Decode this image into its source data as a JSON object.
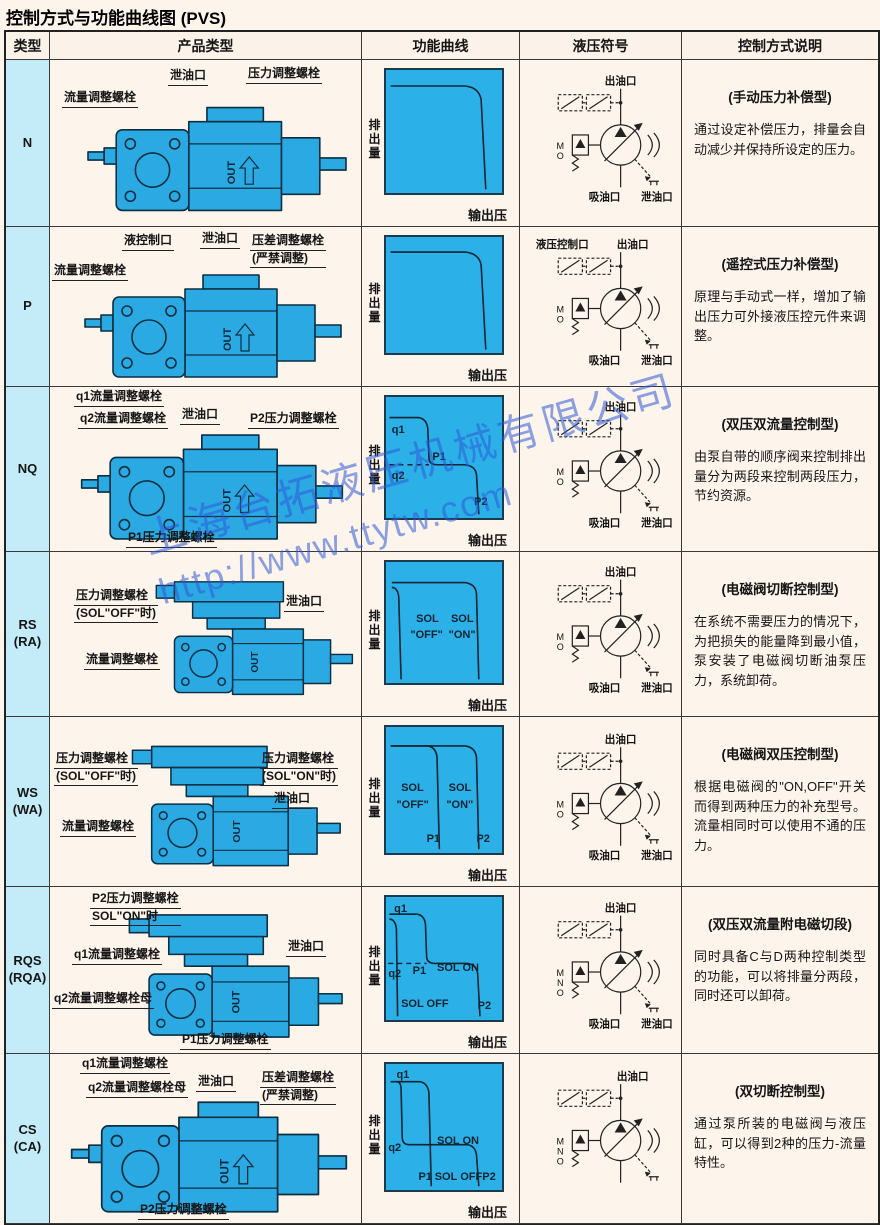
{
  "page": {
    "title": "控制方式与功能曲线图 (PVS)"
  },
  "shared": {
    "pump_text": "OUT",
    "axis_y": "排出量",
    "axis_x": "输出压"
  },
  "watermark": {
    "line1": "上海台拓液压机械有限公司",
    "line2": "http://www.ttytw.com"
  },
  "table": {
    "headers": [
      "类型",
      "产品类型",
      "功能曲线",
      "液压符号",
      "控制方式说明"
    ],
    "rows": [
      {
        "type": "N",
        "type_sub": "",
        "product_labels": [
          {
            "text": "流量调整螺栓"
          },
          {
            "text": "泄油口"
          },
          {
            "text": "压力调整螺栓"
          }
        ],
        "curve_labels": [],
        "symbol": {
          "top": "出油口",
          "bottom_left": "吸油口",
          "bottom_right": "泄油口",
          "letters": [
            "M",
            "O"
          ]
        },
        "desc_title": "(手动压力补偿型)",
        "desc_body": "通过设定补偿压力，排量会自动减少并保持所设定的压力。"
      },
      {
        "type": "P",
        "type_sub": "",
        "product_labels": [
          {
            "text": "流量调整螺栓"
          },
          {
            "text": "液控制口"
          },
          {
            "text": "泄油口"
          },
          {
            "text": "压差调整螺栓",
            "text2": "(严禁调整)"
          }
        ],
        "curve_labels": [],
        "symbol": {
          "top_left": "液压控制口",
          "top": "出油口",
          "bottom_left": "吸油口",
          "bottom_right": "泄油口",
          "letters": [
            "M",
            "O"
          ]
        },
        "desc_title": "(遥控式压力补偿型)",
        "desc_body": "原理与手动式一样，增加了输出压力可外接液压控元件来调整。"
      },
      {
        "type": "NQ",
        "type_sub": "",
        "product_labels": [
          {
            "text": "q1流量调整螺栓"
          },
          {
            "text": "q2流量调整螺栓"
          },
          {
            "text": "泄油口"
          },
          {
            "text": "P2压力调整螺栓"
          },
          {
            "text": "P1压力调整螺栓"
          }
        ],
        "curve_labels": [
          "q1",
          "P1",
          "q2",
          "P2"
        ],
        "symbol": {
          "top": "出油口",
          "bottom_left": "吸油口",
          "bottom_right": "泄油口",
          "letters": [
            "M",
            "O"
          ]
        },
        "desc_title": "(双压双流量控制型)",
        "desc_body": "由泵自带的顺序阀来控制排出量分为两段来控制两段压力，节约资源。"
      },
      {
        "type": "RS",
        "type_sub": "(RA)",
        "product_labels": [
          {
            "text": "压力调整螺栓",
            "text2": "(SOL\"OFF\"时)"
          },
          {
            "text": "泄油口"
          },
          {
            "text": "流量调整螺栓"
          }
        ],
        "curve_labels": [
          "SOL",
          "\"OFF\"",
          "SOL",
          "\"ON\""
        ],
        "symbol": {
          "top": "出油口",
          "bottom_left": "吸油口",
          "bottom_right": "泄油口",
          "letters": [
            "M",
            "O"
          ]
        },
        "desc_title": "(电磁阀切断控制型)",
        "desc_body": "在系统不需要压力的情况下，为把损失的能量降到最小值，泵安装了电磁阀切断油泵压力，系统卸荷。"
      },
      {
        "type": "WS",
        "type_sub": "(WA)",
        "product_labels": [
          {
            "text": "压力调整螺栓",
            "text2": "(SOL\"OFF\"时)"
          },
          {
            "text": "压力调整螺栓",
            "text2": "(SOL\"ON\"时)"
          },
          {
            "text": "泄油口"
          },
          {
            "text": "流量调整螺栓"
          }
        ],
        "curve_labels": [
          "SOL",
          "\"OFF\"",
          "SOL",
          "\"ON\"",
          "P1",
          "P2"
        ],
        "symbol": {
          "top": "出油口",
          "bottom_left": "吸油口",
          "bottom_right": "泄油口",
          "letters": [
            "M",
            "O"
          ]
        },
        "desc_title": "(电磁阀双压控制型)",
        "desc_body": "根据电磁阀的\"ON,OFF\"开关而得到两种压力的补充型号。流量相同时可以使用不通的压力。"
      },
      {
        "type": "RQS",
        "type_sub": "(RQA)",
        "product_labels": [
          {
            "text": "P2压力调整螺栓",
            "text2": "SOL\"ON\"时"
          },
          {
            "text": "q1流量调整螺栓"
          },
          {
            "text": "q2流量调整螺栓母"
          },
          {
            "text": "泄油口"
          },
          {
            "text": "P1压力调整螺栓"
          }
        ],
        "curve_labels": [
          "q1",
          "q2",
          "P1",
          "SOL ON",
          "SOL OFF",
          "P2"
        ],
        "symbol": {
          "top": "出油口",
          "bottom_left": "吸油口",
          "bottom_right": "泄油口",
          "letters": [
            "M",
            "N",
            "O"
          ]
        },
        "desc_title": "(双压双流量附电磁切段)",
        "desc_body": "同时具备C与D两种控制类型的功能，可以将排量分两段，同时还可以卸荷。"
      },
      {
        "type": "CS",
        "type_sub": "(CA)",
        "product_labels": [
          {
            "text": "q1流量调整螺栓"
          },
          {
            "text": "q2流量调整螺栓母"
          },
          {
            "text": "泄油口"
          },
          {
            "text": "压差调整螺栓",
            "text2": "(严禁调整)"
          },
          {
            "text": "P2压力调整螺栓"
          }
        ],
        "curve_labels": [
          "q1",
          "q2",
          "SOL ON",
          "P1",
          "SOL OFF",
          "P2"
        ],
        "symbol": {
          "top": "出油口",
          "bottom_left": "",
          "bottom_right": "",
          "letters": [
            "M",
            "N",
            "O"
          ]
        },
        "desc_title": "(双切断控制型)",
        "desc_body": "通过泵所装的电磁阀与液压缸，可以得到2种的压力-流量特性。"
      }
    ]
  },
  "chart_data": [
    {
      "row": "N",
      "type": "line",
      "title": "手动压力补偿型 功能曲线",
      "xlabel": "输出压",
      "ylabel": "排出量",
      "ticks": "none",
      "series": [
        {
          "name": "压力补偿特性",
          "points_norm": [
            [
              0.02,
              0.97
            ],
            [
              0.72,
              0.97
            ],
            [
              0.84,
              0.85
            ],
            [
              0.88,
              0.02
            ]
          ]
        }
      ],
      "annotations": []
    },
    {
      "row": "P",
      "type": "line",
      "title": "遥控式压力补偿型 功能曲线",
      "xlabel": "输出压",
      "ylabel": "排出量",
      "ticks": "none",
      "series": [
        {
          "name": "压力补偿特性",
          "points_norm": [
            [
              0.02,
              0.97
            ],
            [
              0.72,
              0.97
            ],
            [
              0.84,
              0.85
            ],
            [
              0.88,
              0.02
            ]
          ]
        }
      ],
      "annotations": []
    },
    {
      "row": "NQ",
      "type": "line",
      "title": "双压双流量控制型 功能曲线",
      "xlabel": "输出压",
      "ylabel": "排出量",
      "ticks": "none",
      "series": [
        {
          "name": "双压双流量特性",
          "points_norm": [
            [
              0.02,
              0.92
            ],
            [
              0.3,
              0.92
            ],
            [
              0.38,
              0.5
            ],
            [
              0.7,
              0.5
            ],
            [
              0.8,
              0.02
            ]
          ]
        }
      ],
      "annotations": [
        "q1",
        "P1",
        "q2",
        "P2"
      ],
      "dashed_guide": "q2流量水平虚线"
    },
    {
      "row": "RS",
      "type": "line",
      "title": "电磁阀切断控制型 功能曲线",
      "xlabel": "输出压",
      "ylabel": "排出量",
      "ticks": "none",
      "series": [
        {
          "name": "SOL \"OFF\"",
          "points_norm": [
            [
              0.05,
              0.85
            ],
            [
              0.12,
              0.02
            ]
          ]
        },
        {
          "name": "SOL \"ON\"",
          "points_norm": [
            [
              0.05,
              0.88
            ],
            [
              0.7,
              0.88
            ],
            [
              0.8,
              0.02
            ]
          ]
        }
      ],
      "annotations": [
        "SOL \"OFF\"",
        "SOL \"ON\""
      ]
    },
    {
      "row": "WS",
      "type": "line",
      "title": "电磁阀双压控制型 功能曲线",
      "xlabel": "输出压",
      "ylabel": "排出量",
      "ticks": "none",
      "series": [
        {
          "name": "SOL \"OFF\" (P1)",
          "points_norm": [
            [
              0.04,
              0.9
            ],
            [
              0.38,
              0.9
            ],
            [
              0.46,
              0.02
            ]
          ]
        },
        {
          "name": "SOL \"ON\" (P2)",
          "points_norm": [
            [
              0.04,
              0.9
            ],
            [
              0.7,
              0.9
            ],
            [
              0.8,
              0.02
            ]
          ]
        }
      ],
      "annotations": [
        "SOL \"OFF\"",
        "SOL \"ON\"",
        "P1",
        "P2"
      ]
    },
    {
      "row": "RQS",
      "type": "line",
      "title": "双压双流量附电磁切段 功能曲线",
      "xlabel": "输出压",
      "ylabel": "排出量",
      "ticks": "none",
      "series": [
        {
          "name": "SOL OFF",
          "points_norm": [
            [
              0.03,
              0.85
            ],
            [
              0.1,
              0.02
            ]
          ]
        },
        {
          "name": "SOL ON",
          "points_norm": [
            [
              0.03,
              0.9
            ],
            [
              0.29,
              0.9
            ],
            [
              0.35,
              0.48
            ],
            [
              0.72,
              0.48
            ],
            [
              0.82,
              0.02
            ]
          ]
        }
      ],
      "annotations": [
        "q1",
        "q2",
        "P1",
        "SOL ON",
        "SOL OFF",
        "P2"
      ],
      "dashed_guide": "q2流量水平虚线"
    },
    {
      "row": "CS",
      "type": "line",
      "title": "双切断控制型 功能曲线",
      "xlabel": "输出压",
      "ylabel": "排出量",
      "ticks": "none",
      "series": [
        {
          "name": "SOL OFF (P1切断)",
          "points_norm": [
            [
              0.04,
              0.9
            ],
            [
              0.31,
              0.9
            ],
            [
              0.39,
              0.02
            ]
          ]
        },
        {
          "name": "SOL ON (P2特性)",
          "points_norm": [
            [
              0.1,
              0.9
            ],
            [
              0.13,
              0.4
            ],
            [
              0.72,
              0.4
            ],
            [
              0.81,
              0.02
            ]
          ]
        }
      ],
      "annotations": [
        "q1",
        "q2",
        "SOL ON",
        "P1",
        "SOL OFF",
        "P2"
      ]
    }
  ]
}
